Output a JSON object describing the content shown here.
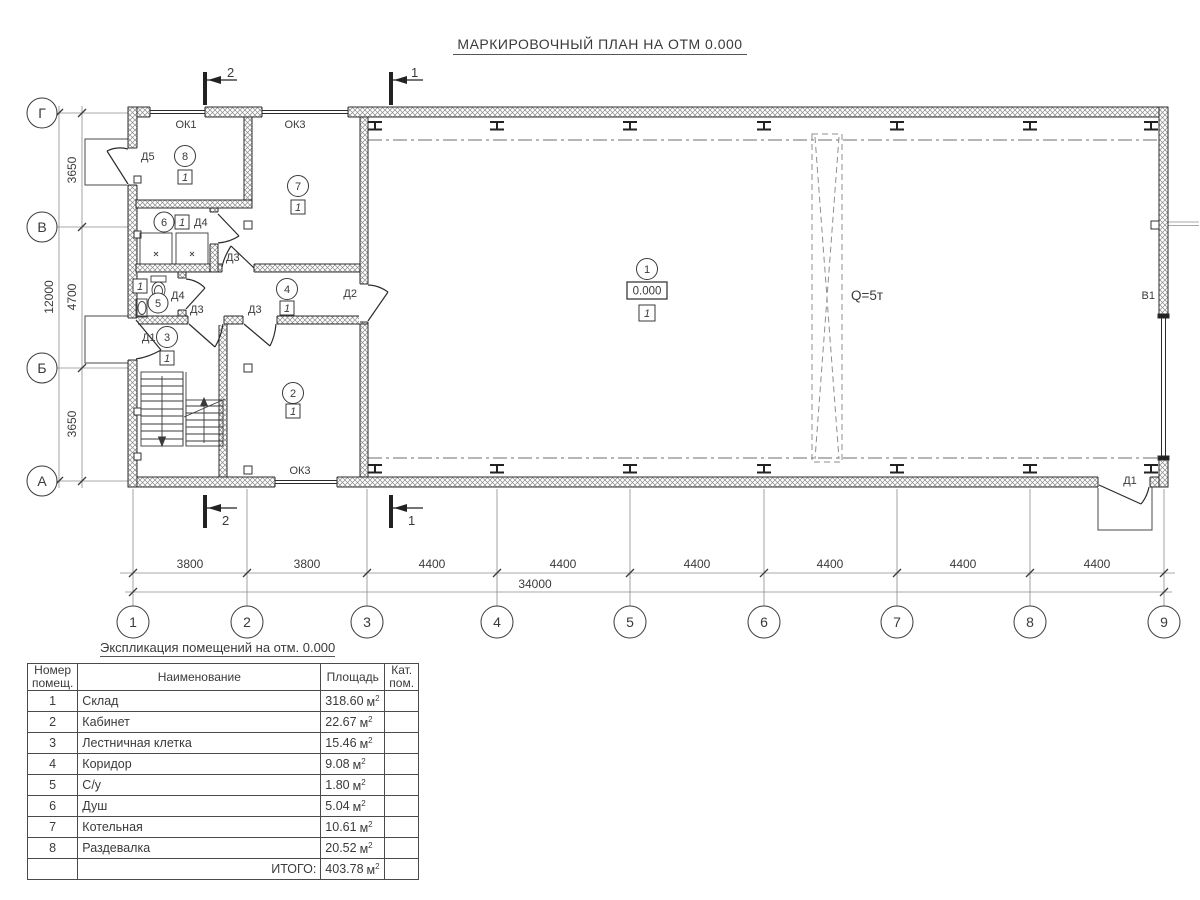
{
  "title": "МАРКИРОВОЧНЫЙ ПЛАН НА ОТМ 0.000",
  "plan": {
    "sections": {
      "s1": "1",
      "s2": "2"
    },
    "axes": {
      "rows": [
        "Г",
        "В",
        "Б",
        "А"
      ],
      "cols": [
        "1",
        "2",
        "3",
        "4",
        "5",
        "6",
        "7",
        "8",
        "9"
      ]
    },
    "dims": {
      "left_segments": [
        "3650",
        "4700",
        "3650"
      ],
      "left_total": "12000",
      "bottom_segments": [
        "3800",
        "3800",
        "4400",
        "4400",
        "4400",
        "4400",
        "4400",
        "4400"
      ],
      "bottom_total": "34000"
    },
    "labels": {
      "ok1": "ОК1",
      "ok3": "ОК3",
      "d1": "Д1",
      "d2": "Д2",
      "d3": "Д3",
      "d4": "Д4",
      "d5": "Д5",
      "v1": "В1",
      "crane": "Q=5т",
      "elevation": "0.000",
      "cat": "1"
    },
    "rooms": [
      "1",
      "2",
      "3",
      "4",
      "5",
      "6",
      "7",
      "8"
    ]
  },
  "table": {
    "title": "Экспликация помещений на отм. 0.000",
    "headers": {
      "num": "Номер помещ.",
      "name": "Наименование",
      "area": "Площадь",
      "cat": "Кат. пом."
    },
    "unit": "м",
    "sup": "2",
    "rows": [
      {
        "num": "1",
        "name": "Склад",
        "area": "318.60"
      },
      {
        "num": "2",
        "name": "Кабинет",
        "area": "22.67"
      },
      {
        "num": "3",
        "name": "Лестничная клетка",
        "area": "15.46"
      },
      {
        "num": "4",
        "name": "Коридор",
        "area": "9.08"
      },
      {
        "num": "5",
        "name": "С/у",
        "area": "1.80"
      },
      {
        "num": "6",
        "name": "Душ",
        "area": "5.04"
      },
      {
        "num": "7",
        "name": "Котельная",
        "area": "10.61"
      },
      {
        "num": "8",
        "name": "Раздевалка",
        "area": "20.52"
      }
    ],
    "total_label": "ИТОГО:",
    "total_area": "403.78"
  }
}
